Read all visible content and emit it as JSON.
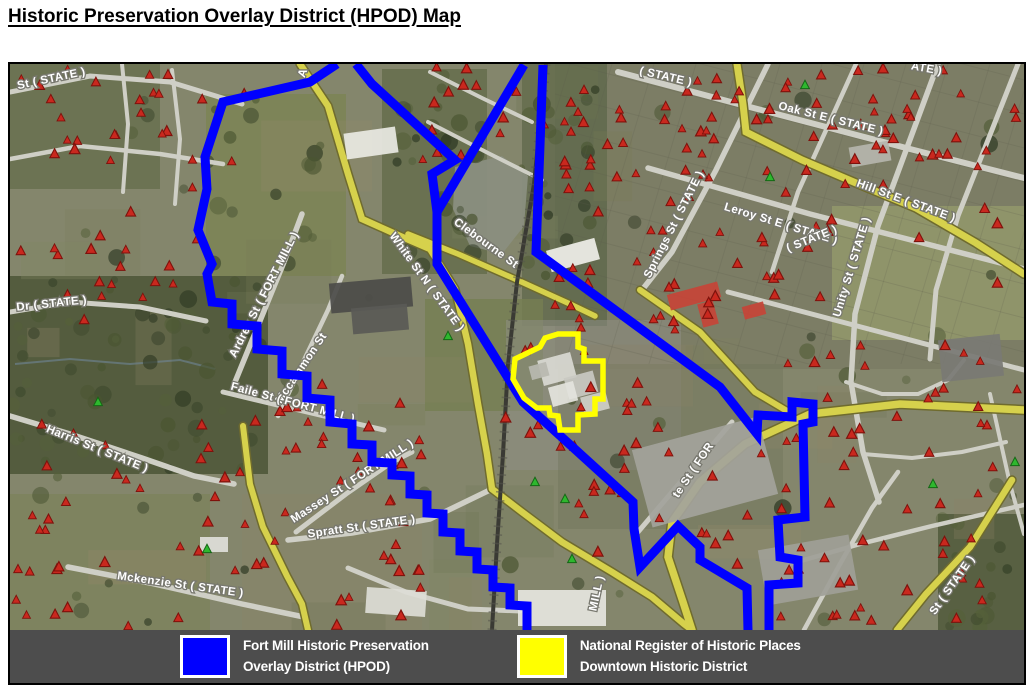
{
  "page": {
    "title": "Historic Preservation Overlay District (HPOD) Map"
  },
  "legend": {
    "items": [
      {
        "line1": "Fort Mill Historic Preservation",
        "line2": "Overlay District (HPOD)",
        "color": "#0000ff"
      },
      {
        "line1": "National Register of Historic Places",
        "line2": "Downtown Historic District",
        "color": "#ffff00"
      }
    ]
  },
  "map": {
    "hpod_color": "#0000ff",
    "nr_color": "#ffff00",
    "marker_color": "#c9281e",
    "marker_color_alt": "#2eb82e",
    "street_labels": [
      {
        "t": "St ( STATE )",
        "x": 42,
        "y": 18,
        "r": -12
      },
      {
        "t": "A",
        "x": 296,
        "y": 10,
        "r": -70
      },
      {
        "t": "( STATE )",
        "x": 655,
        "y": 16,
        "r": 13
      },
      {
        "t": "Oak St E ( STATE )",
        "x": 820,
        "y": 58,
        "r": 14
      },
      {
        "t": "ATE )",
        "x": 916,
        "y": 8,
        "r": 10
      },
      {
        "t": "Hill St E ( STATE )",
        "x": 895,
        "y": 140,
        "r": 20
      },
      {
        "t": "Leroy St E ( STATE )",
        "x": 770,
        "y": 163,
        "r": 17
      },
      {
        "t": "Springs St ( STATE )",
        "x": 667,
        "y": 162,
        "r": -63
      },
      {
        "t": "Unity St ( STATE )",
        "x": 845,
        "y": 204,
        "r": -73
      },
      {
        "t": "( STATE )",
        "x": 803,
        "y": 178,
        "r": -22
      },
      {
        "t": "White St N ( STATE )",
        "x": 414,
        "y": 220,
        "r": 54
      },
      {
        "t": "Clebourne St",
        "x": 474,
        "y": 182,
        "r": 36
      },
      {
        "t": "Dr ( STATE )",
        "x": 42,
        "y": 243,
        "r": -6
      },
      {
        "t": "Ardrey St ( FORT MILL )",
        "x": 257,
        "y": 232,
        "r": -63
      },
      {
        "t": "Mccammon St",
        "x": 294,
        "y": 306,
        "r": -56
      },
      {
        "t": "Faile St ( FORT MILL )",
        "x": 282,
        "y": 342,
        "r": 15
      },
      {
        "t": "Harris St ( STATE )",
        "x": 86,
        "y": 388,
        "r": 22
      },
      {
        "t": "Massey St ( FORT MILL )",
        "x": 344,
        "y": 420,
        "r": -33
      },
      {
        "t": "Spratt St ( STATE )",
        "x": 352,
        "y": 466,
        "r": -8
      },
      {
        "t": "Mckenzie St ( STATE )",
        "x": 170,
        "y": 524,
        "r": 8
      },
      {
        "t": "te St ( FOR",
        "x": 686,
        "y": 408,
        "r": -56
      },
      {
        "t": "MILL )",
        "x": 590,
        "y": 530,
        "r": -78
      },
      {
        "t": "St ( STATE )",
        "x": 945,
        "y": 523,
        "r": -55
      }
    ]
  }
}
